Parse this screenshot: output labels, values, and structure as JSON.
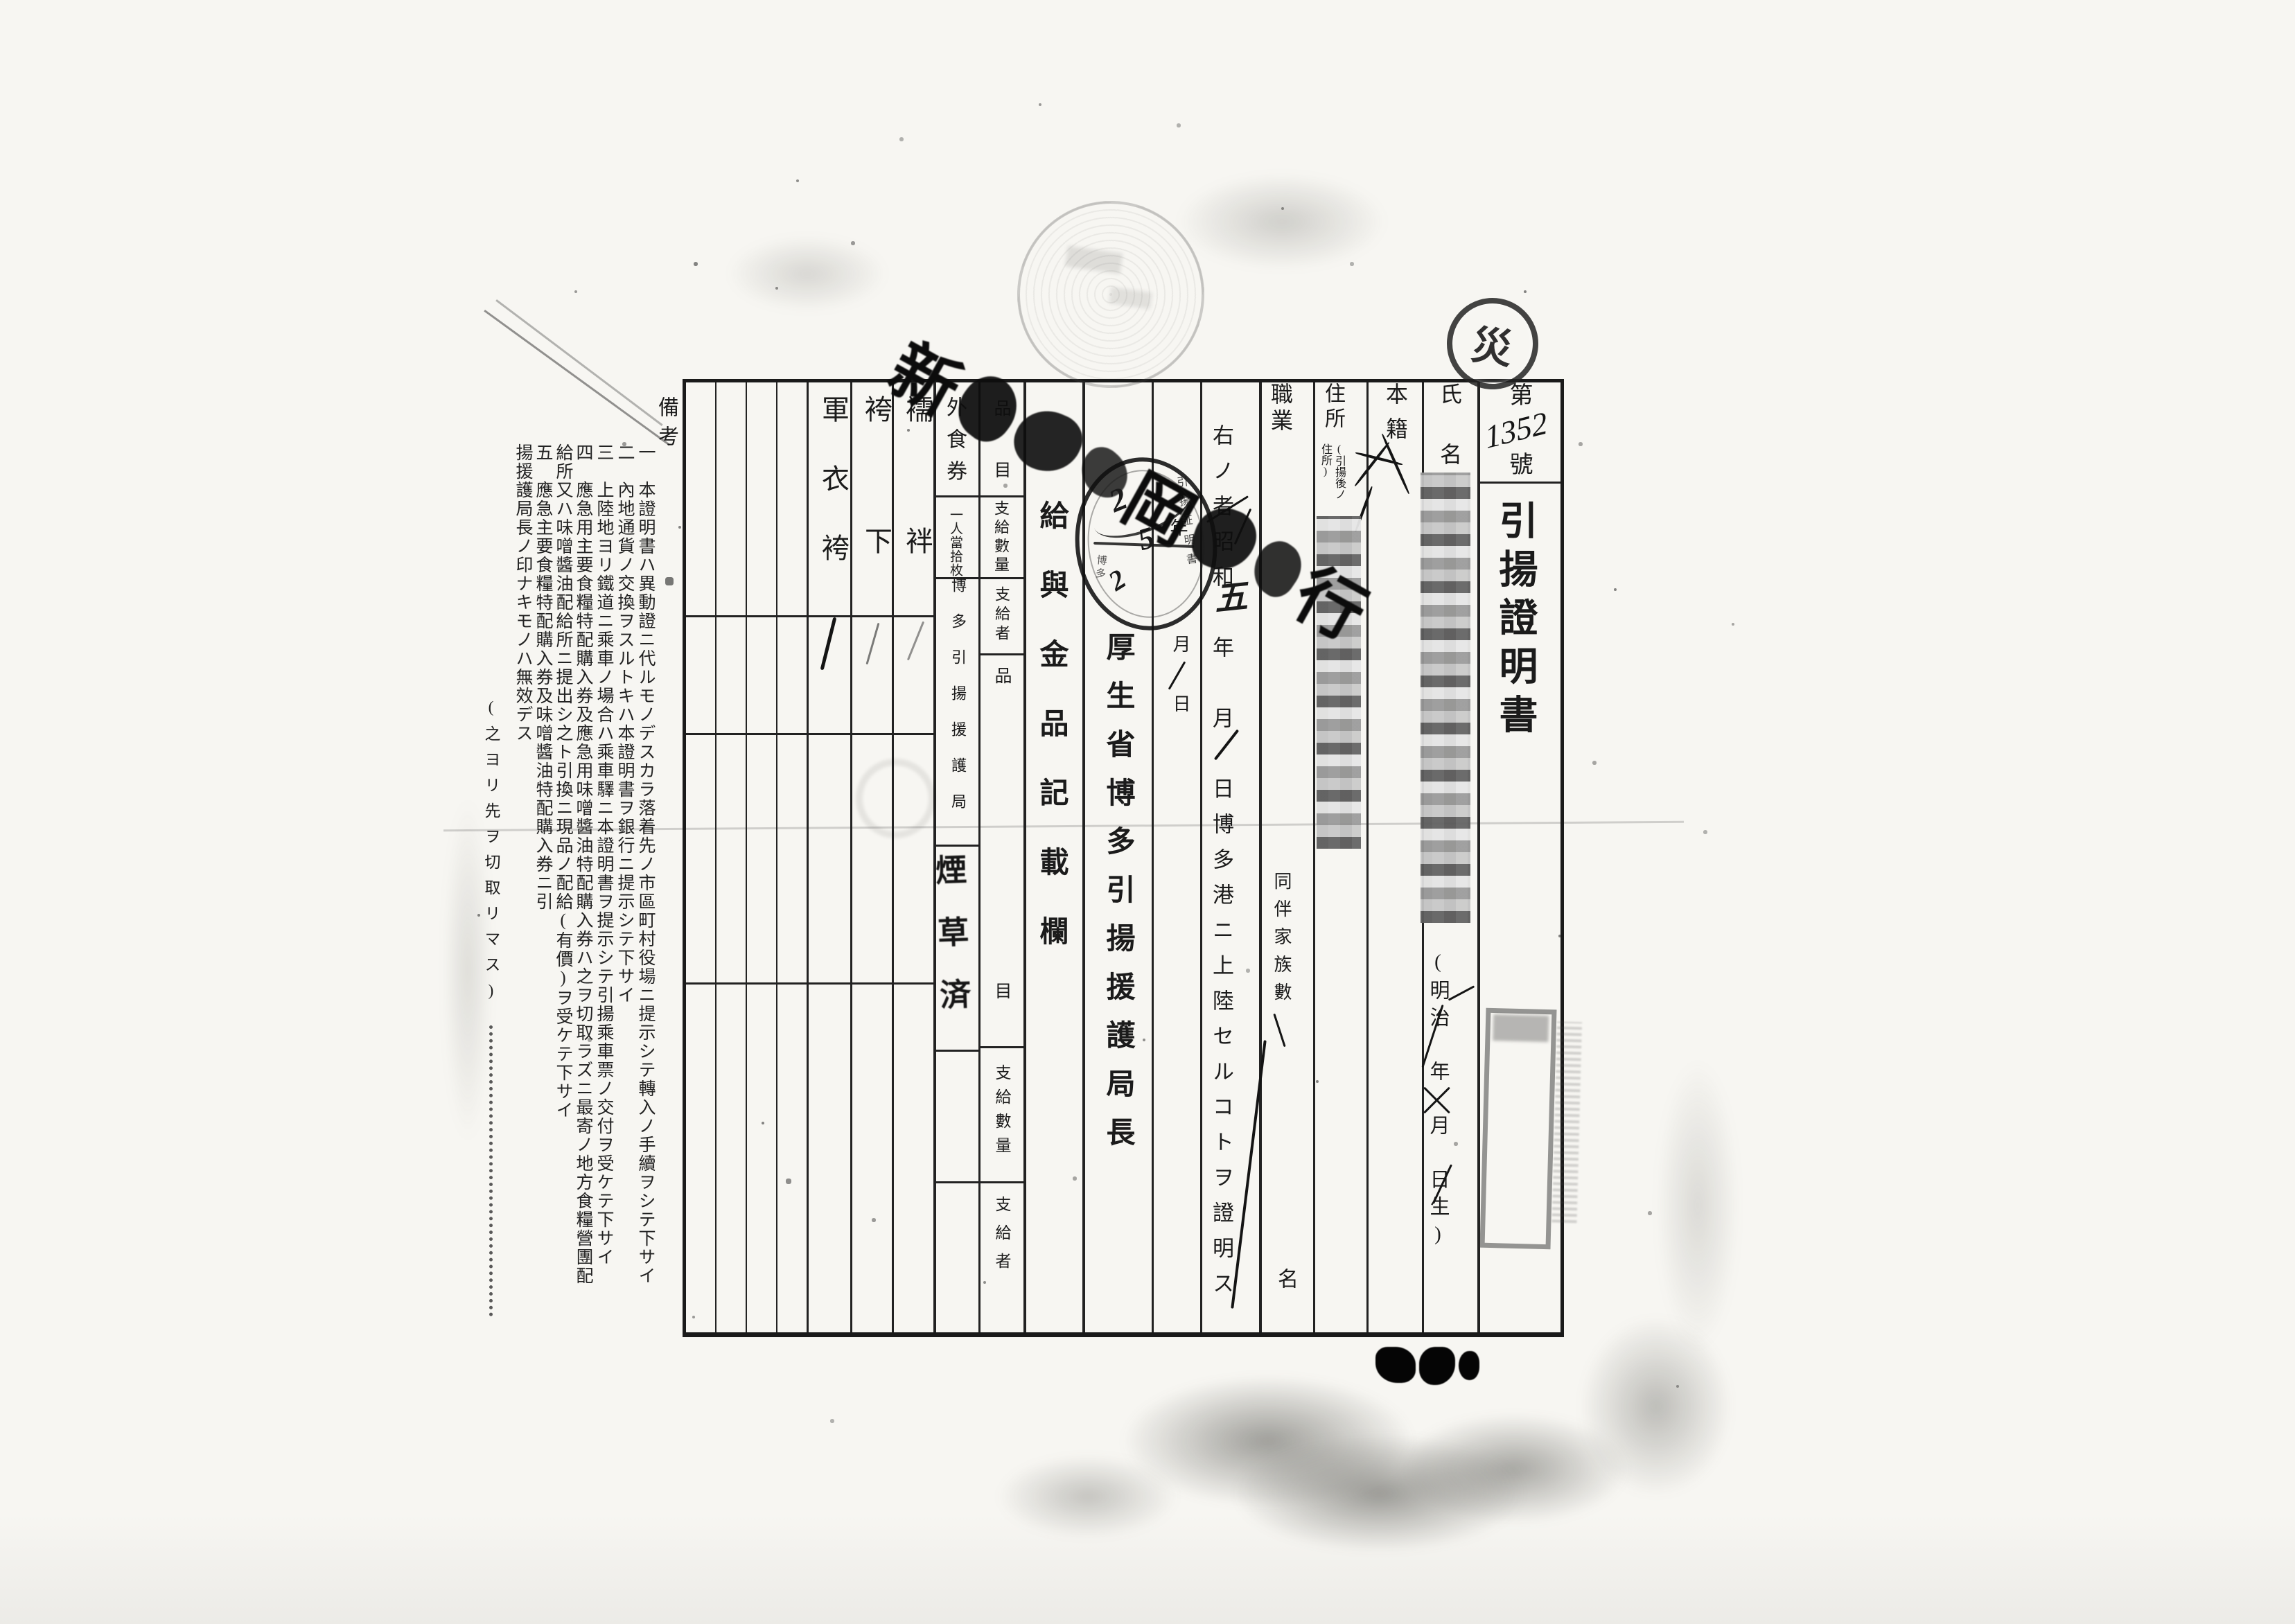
{
  "header": {
    "no_prefix": "第",
    "no_value": "1352",
    "no_suffix": "號",
    "title": "引揚證明書"
  },
  "fields": {
    "name_label": "氏名",
    "birth_template": "(明治　年　月　日生)",
    "domicile_label": "本籍",
    "address_label": "住所",
    "address_note": "(引揚後ノ住所)",
    "occupation_label": "職業",
    "family_label": "同伴家族數",
    "family_unit": "名"
  },
  "censored": {
    "name_alt": "氏名欄(モザイク処理)",
    "address_alt": "記載内容(モザイク処理)"
  },
  "certification": {
    "sentence": "右ノ者昭和　年　月　日博多港ニ上陸セルコトヲ證明ス",
    "handwritten_month": "五",
    "issue_year_char": "年",
    "issue_month_char": "月",
    "issue_day_char": "日",
    "issuer": "厚生省博多引揚援護局長"
  },
  "table": {
    "header": "給與金品記載欄",
    "label_item": "品目",
    "label_qty": "支給數量",
    "label_giver": "支給者",
    "row1": {
      "item": "外食券",
      "qty": "一人當拾枚",
      "giver": "博多引揚援護局"
    },
    "stamp_tobacco": "煙草済",
    "items": [
      "襦袢",
      "袴下",
      "軍衣袴"
    ]
  },
  "remarks": {
    "header": "備考",
    "notes": [
      {
        "no": "一",
        "text": "本證明書ハ異動證ニ代ルモノデスカラ落着先ノ市區町村役場ニ提示シテ轉入ノ手續ヲシテ下サイ"
      },
      {
        "no": "二",
        "text": "內地通貨ノ交換ヲスルトキハ本證明書ヲ銀行ニ提示シテ下サイ"
      },
      {
        "no": "三",
        "text": "上陸地ヨリ鐵道ニ乘車ノ場合ハ乘車驛ニ本證明書ヲ提示シテ引揚乘車票ノ交付ヲ受ケテ下サイ"
      },
      {
        "no": "四",
        "text": "應急用主要食糧特配購入券及應急用味噌醬油特配購入券ハ之ヲ切取ラズニ最寄ノ地方食糧營團配給所又ハ味噌醬油配給所ニ提出シ之ト引換ニ現品ノ配給(有價)ヲ受ケテ下サイ"
      },
      {
        "no": "五",
        "text": "應急主要食糧特配購入券及味噌醬油特配購入券ニ引揚援護局長ノ印ナキモノハ無效デス"
      }
    ]
  },
  "margin": {
    "cut_note": "(之ヨリ先ヲ切取リマス)"
  },
  "stamps": {
    "diagonal_first": "新",
    "diagonal_mid": "岡",
    "diagonal_last": "行",
    "diagonal_alt": "大型斜め押印(大部分判読不能)",
    "round_ring_text": "引揚証明書",
    "round_ring_text2": "博多",
    "round_digit1": "2",
    "round_digit2": "5",
    "round_digit3": "2",
    "round_alt": "円形日付印(書込みあり・判読不能)",
    "sai_char": "災",
    "rect_alt": "長方形の枠型印影",
    "bottom_alt": "判読不能の黒インク印",
    "postmark_alt": "薄い円形消印(判読不能)"
  }
}
